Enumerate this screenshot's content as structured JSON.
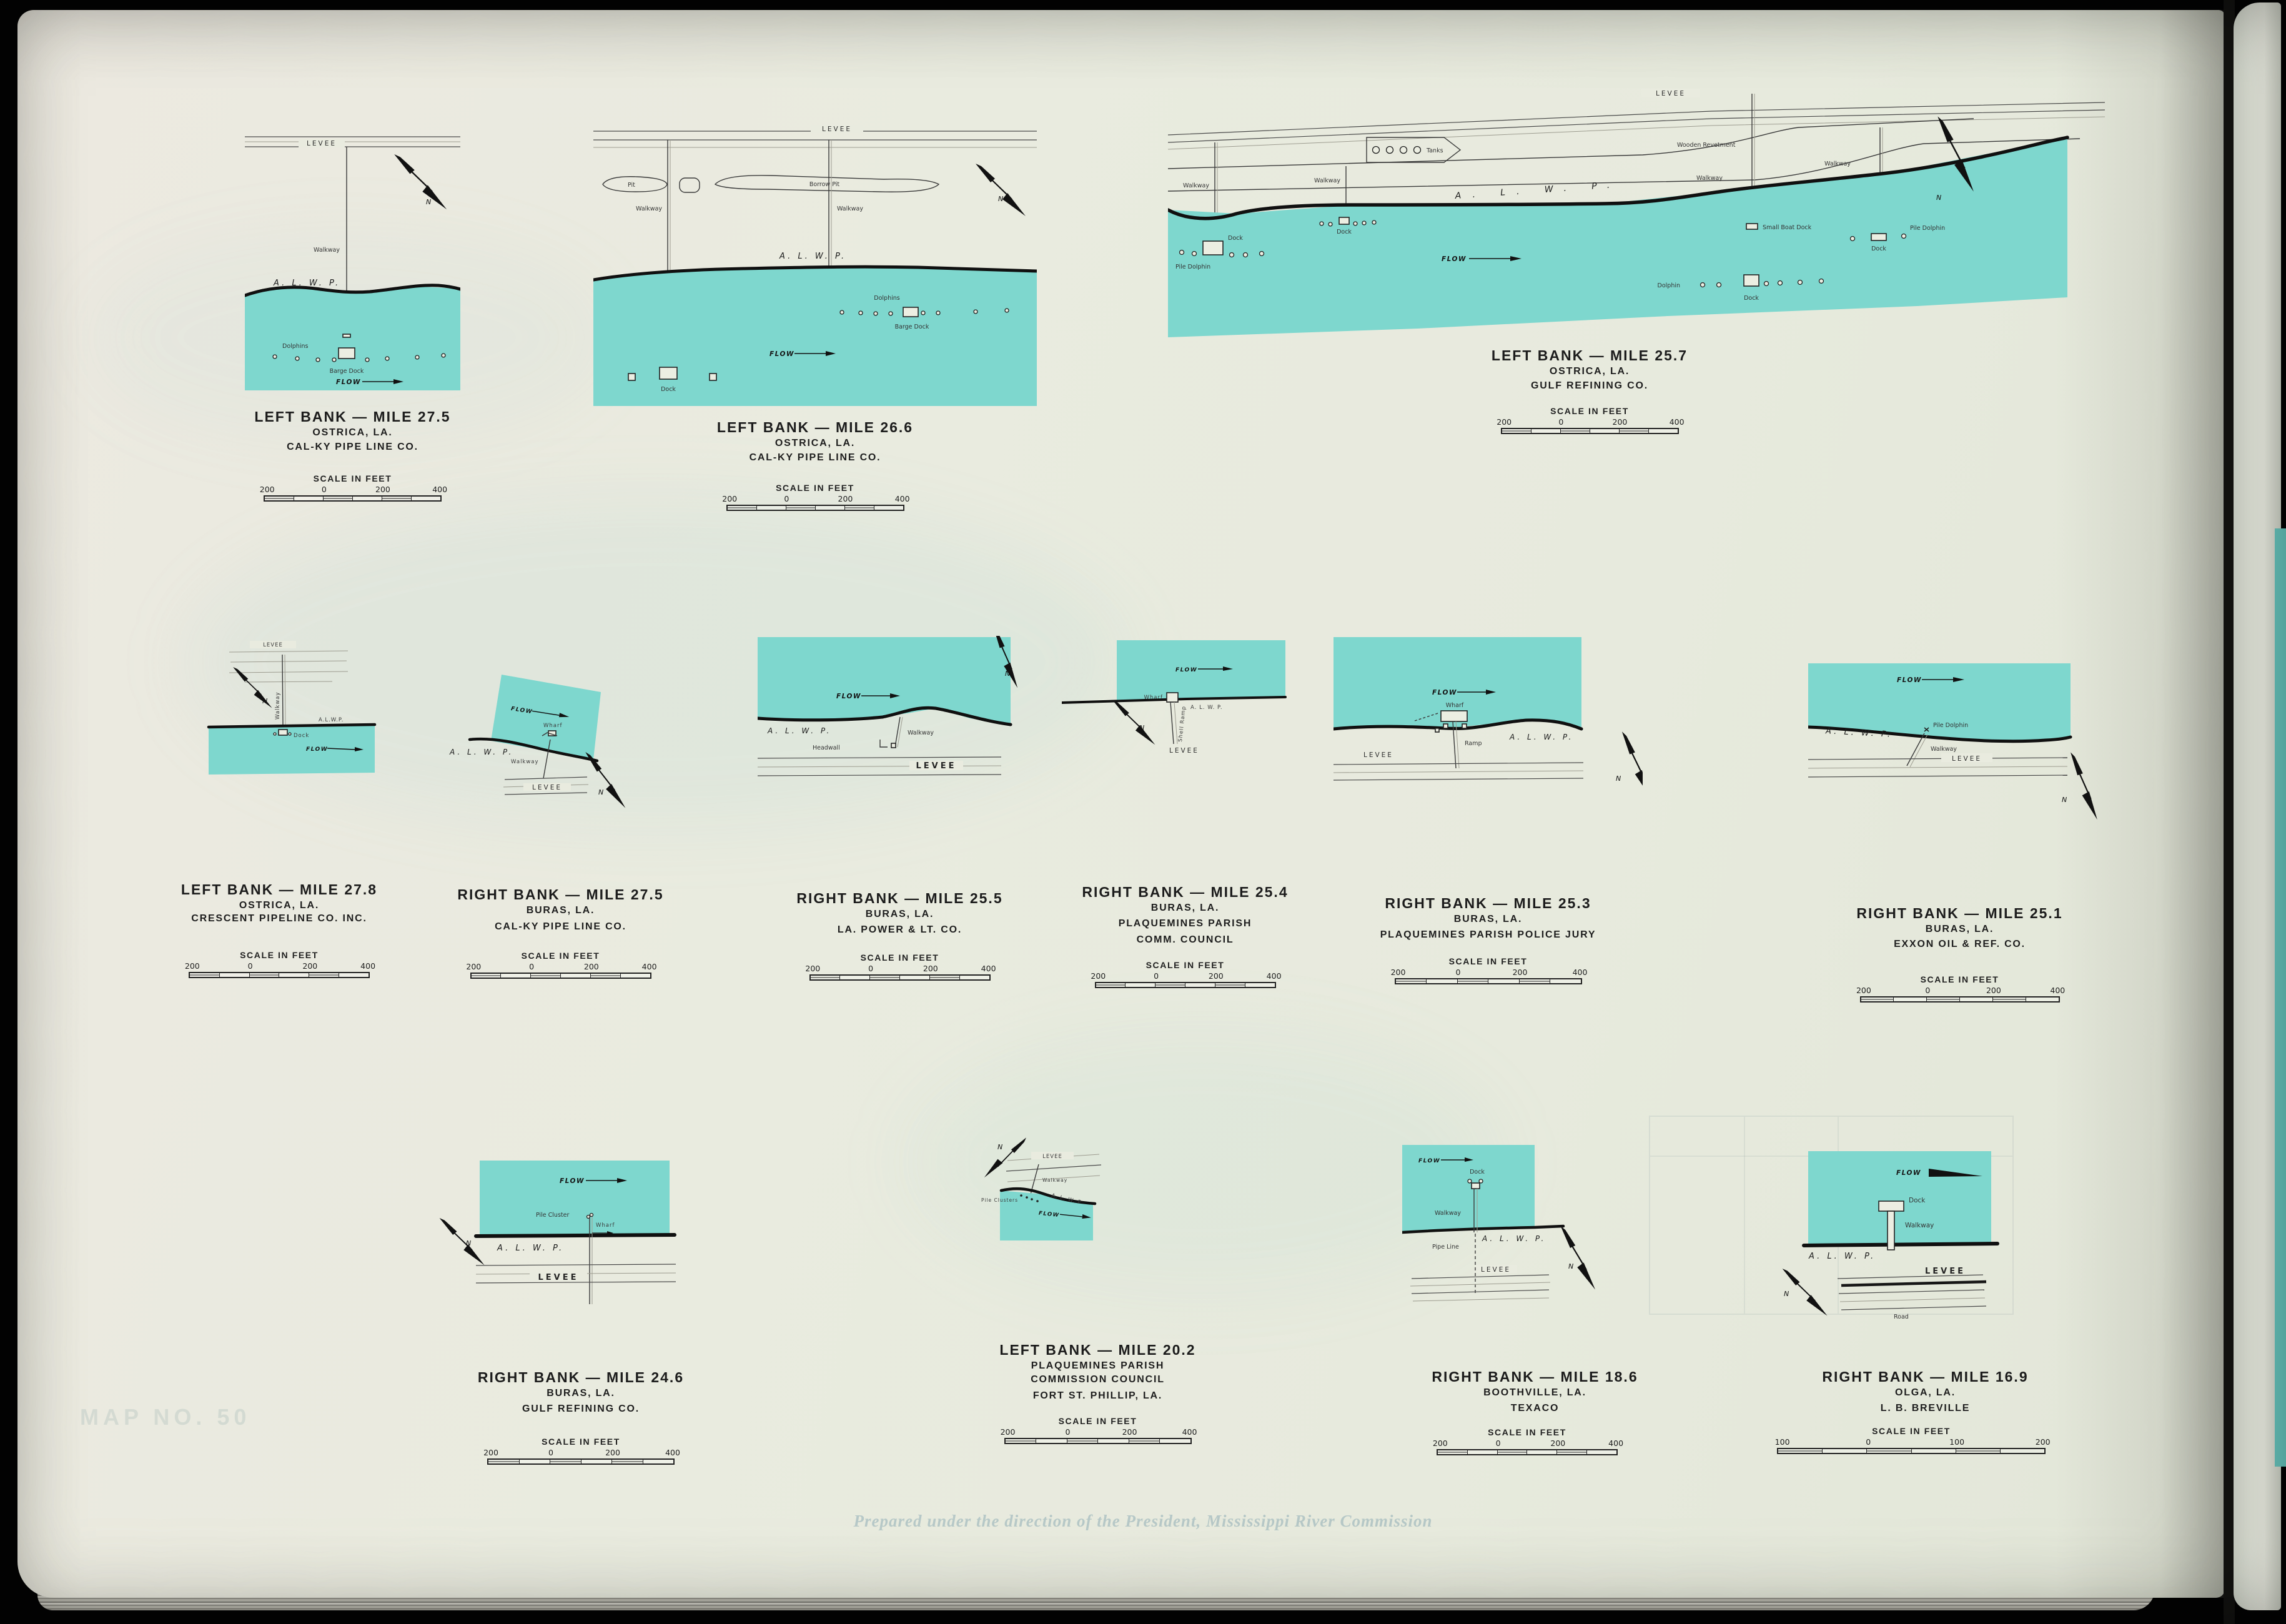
{
  "colors": {
    "water": "#7ed7ce",
    "page": "#e9ebdf",
    "ink": "#1b1b1b",
    "book_edge": "#6ac9c1"
  },
  "ghosts": {
    "imprint": "Prepared under the direction of the President, Mississippi River Commission",
    "map_no": "MAP NO. 50"
  },
  "panels": [
    {
      "title": "LEFT BANK — MILE 27.5",
      "sub1": "OSTRICA, LA.",
      "sub2": "CAL-KY PIPE LINE CO.",
      "scale": {
        "title": "SCALE IN FEET",
        "labels": [
          "200",
          "0",
          "200",
          "400"
        ]
      },
      "ann": {
        "levee": "LEVEE",
        "walkway": "Walkway",
        "alwp": "A. L. W. P.",
        "dolphins": "Dolphins",
        "barge_dock": "Barge Dock",
        "flow": "FLOW",
        "north": "N"
      }
    },
    {
      "title": "LEFT BANK — MILE 26.6",
      "sub1": "OSTRICA, LA.",
      "sub2": "CAL-KY PIPE LINE CO.",
      "scale": {
        "title": "SCALE IN FEET",
        "labels": [
          "200",
          "0",
          "200",
          "400"
        ]
      },
      "ann": {
        "levee": "LEVEE",
        "pit": "Pit",
        "borrow_pit": "Borrow  Pit",
        "walkway1": "Walkway",
        "walkway2": "Walkway",
        "alwp": "A. L. W. P.",
        "dolphins": "Dolphins",
        "barge_dock": "Barge Dock",
        "dock": "Dock",
        "flow": "FLOW",
        "north": "N"
      }
    },
    {
      "title": "LEFT BANK — MILE 25.7",
      "sub1": "OSTRICA, LA.",
      "sub2": "GULF REFINING CO.",
      "scale": {
        "title": "SCALE IN FEET",
        "labels": [
          "200",
          "0",
          "200",
          "400"
        ]
      },
      "ann": {
        "levee": "LEVEE",
        "wooden_revetment": "Wooden  Revetment",
        "tanks": "Tanks",
        "walkway1": "Walkway",
        "walkway2": "Walkway",
        "walkway3": "Walkway",
        "walkway4": "Walkway",
        "alwp": "A. L. W. P.",
        "flow": "FLOW",
        "dock1": "Dock",
        "dock2": "Dock",
        "dock3": "Dock",
        "dock4": "Dock",
        "small_boat_dock": "Small Boat Dock",
        "pile_dolphin1": "Pile Dolphin",
        "pile_dolphin2": "Pile Dolphin",
        "dolphin": "Dolphin",
        "north": "N"
      }
    },
    {
      "title": "LEFT BANK — MILE 27.8",
      "sub1": "OSTRICA, LA.",
      "sub2": "CRESCENT PIPELINE CO. INC.",
      "scale": {
        "title": "SCALE IN FEET",
        "labels": [
          "200",
          "0",
          "200",
          "400"
        ]
      },
      "ann": {
        "levee": "LEVEE",
        "walkway": "Walkway",
        "alwp": "A.L.W.P.",
        "dock": "Dock",
        "flow": "FLOW",
        "north": "N"
      }
    },
    {
      "title": "RIGHT BANK — MILE 27.5",
      "sub1": "BURAS, LA.",
      "sub2": "CAL-KY PIPE LINE CO.",
      "scale": {
        "title": "SCALE IN FEET",
        "labels": [
          "200",
          "0",
          "200",
          "400"
        ]
      },
      "ann": {
        "flow": "FLOW",
        "wharf": "Wharf",
        "alwp": "A. L. W. P.",
        "walkway": "Walkway",
        "levee": "LEVEE",
        "north": "N"
      }
    },
    {
      "title": "RIGHT BANK — MILE 25.5",
      "sub1": "BURAS, LA.",
      "sub2": "LA. POWER & LT. CO.",
      "scale": {
        "title": "SCALE IN FEET",
        "labels": [
          "200",
          "0",
          "200",
          "400"
        ]
      },
      "ann": {
        "flow": "FLOW",
        "alwp": "A. L. W. P.",
        "walkway": "Walkway",
        "headwall": "Headwall",
        "levee": "LEVEE",
        "north": "N"
      }
    },
    {
      "title": "RIGHT BANK — MILE 25.4",
      "sub1": "BURAS, LA.",
      "sub2": "PLAQUEMINES PARISH",
      "sub3": "COMM. COUNCIL",
      "scale": {
        "title": "SCALE IN FEET",
        "labels": [
          "200",
          "0",
          "200",
          "400"
        ]
      },
      "ann": {
        "flow": "FLOW",
        "wharf": "Wharf",
        "alwp": "A. L. W. P.",
        "shell_ramp": "Shell Ramp",
        "levee": "LEVEE",
        "north": "N"
      }
    },
    {
      "title": "RIGHT BANK — MILE 25.3",
      "sub1": "BURAS, LA.",
      "sub2": "PLAQUEMINES PARISH POLICE JURY",
      "scale": {
        "title": "SCALE IN FEET",
        "labels": [
          "200",
          "0",
          "200",
          "400"
        ]
      },
      "ann": {
        "flow": "FLOW",
        "wharf": "Wharf",
        "ramp": "Ramp",
        "alwp": "A. L. W. P.",
        "levee": "LEVEE",
        "north": "N"
      }
    },
    {
      "title": "RIGHT BANK — MILE 25.1",
      "sub1": "BURAS, LA.",
      "sub2": "EXXON OIL & REF. CO.",
      "scale": {
        "title": "SCALE IN FEET",
        "labels": [
          "200",
          "0",
          "200",
          "400"
        ]
      },
      "ann": {
        "flow": "FLOW",
        "alwp": "A. L. W. P.",
        "pile_dolphin": "Pile Dolphin",
        "walkway": "Walkway",
        "levee": "LEVEE",
        "north": "N"
      }
    },
    {
      "title": "RIGHT BANK — MILE 24.6",
      "sub1": "BURAS, LA.",
      "sub2": "GULF REFINING CO.",
      "scale": {
        "title": "SCALE IN FEET",
        "labels": [
          "200",
          "0",
          "200",
          "400"
        ]
      },
      "ann": {
        "flow": "FLOW",
        "pile_cluster": "Pile Cluster",
        "wharf": "Wharf",
        "alwp": "A. L. W. P.",
        "levee": "LEVEE",
        "north": "N"
      }
    },
    {
      "title": "LEFT BANK — MILE 20.2",
      "sub1": "PLAQUEMINES PARISH",
      "sub2": "COMMISSION COUNCIL",
      "sub3": "FORT ST. PHILLIP, LA.",
      "scale": {
        "title": "SCALE IN FEET",
        "labels": [
          "200",
          "0",
          "200",
          "400"
        ]
      },
      "ann": {
        "north": "N",
        "levee": "LEVEE",
        "walkway": "Walkway",
        "alwp": "A. L. W. P",
        "pile_clusters": "Pile Clusters",
        "flow": "FLOW"
      }
    },
    {
      "title": "RIGHT BANK — MILE 18.6",
      "sub1": "BOOTHVILLE, LA.",
      "sub2": "TEXACO",
      "scale": {
        "title": "SCALE IN FEET",
        "labels": [
          "200",
          "0",
          "200",
          "400"
        ]
      },
      "ann": {
        "flow": "FLOW",
        "dock": "Dock",
        "walkway": "Walkway",
        "alwp": "A. L. W. P.",
        "pipe_line": "Pipe Line",
        "levee": "LEVEE",
        "north": "N"
      }
    },
    {
      "title": "RIGHT BANK — MILE 16.9",
      "sub1": "OLGA, LA.",
      "sub2": "L. B. BREVILLE",
      "scale": {
        "title": "SCALE IN FEET",
        "labels": [
          "100",
          "0",
          "100",
          "200"
        ]
      },
      "ann": {
        "flow": "FLOW",
        "dock": "Dock",
        "walkway": "Walkway",
        "alwp": "A. L. W. P.",
        "levee": "LEVEE",
        "road": "Road",
        "north": "N"
      }
    }
  ]
}
